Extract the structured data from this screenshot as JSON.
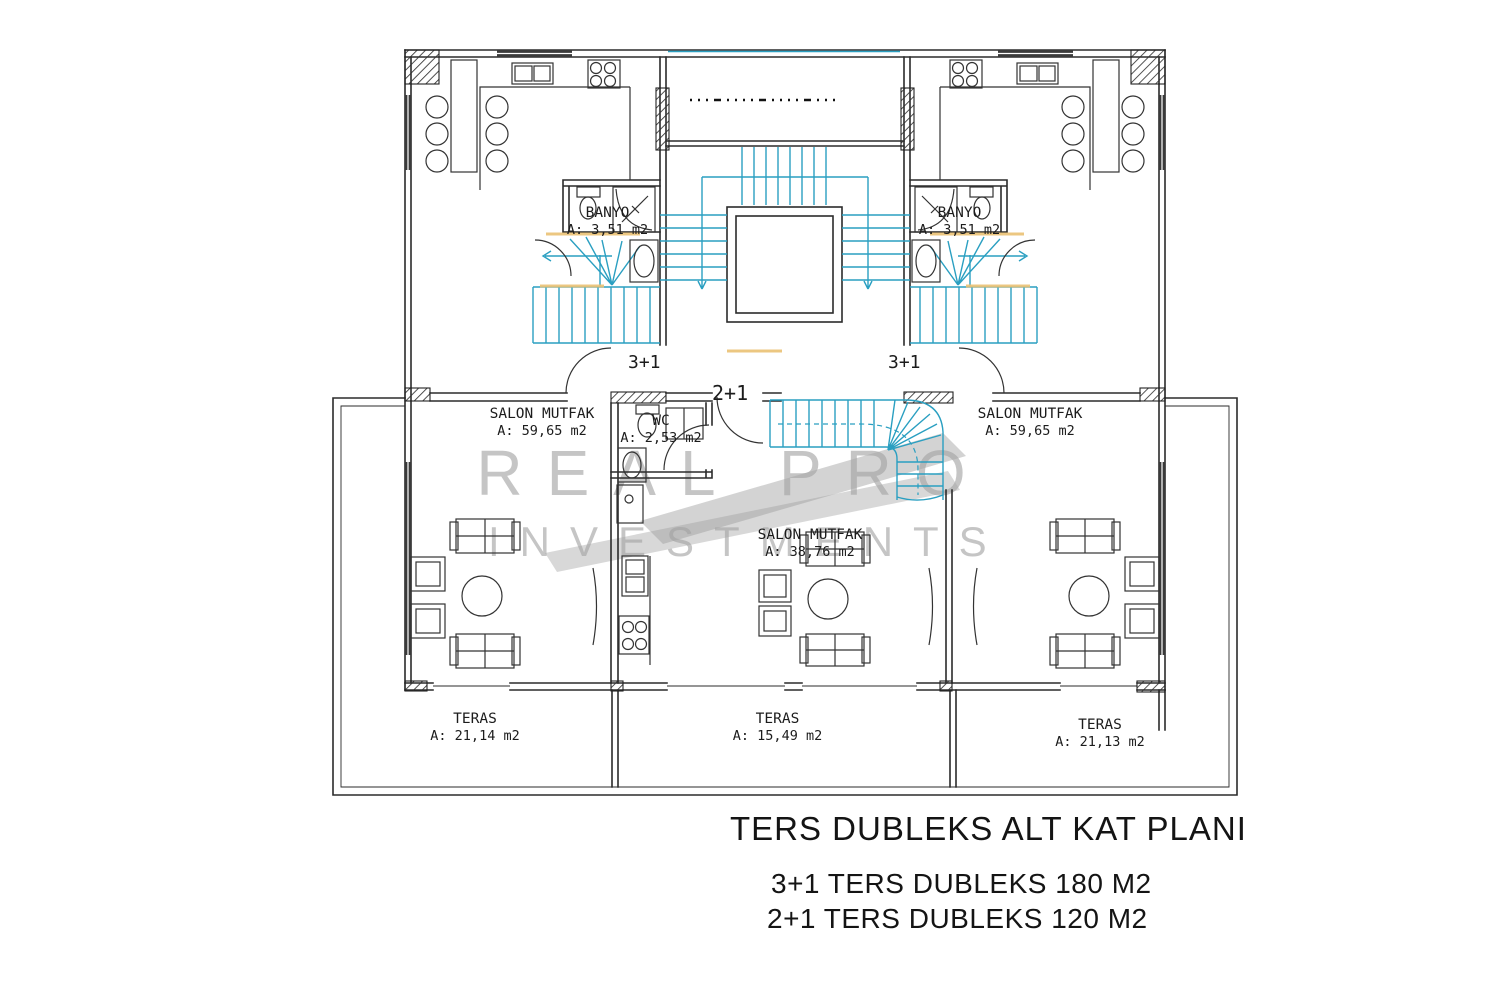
{
  "title_block": {
    "title": "TERS DUBLEKS ALT KAT PLANI",
    "line1": "3+1 TERS DUBLEKS 180 M2",
    "line2": "2+1 TERS DUBLEKS 120 M2"
  },
  "watermark": {
    "line1": "REAL PRO",
    "line2": "INVESTMENTS"
  },
  "units": {
    "left": "3+1",
    "right": "3+1",
    "center": "2+1"
  },
  "rooms": {
    "banyo_left": {
      "name": "BANYO",
      "area": "A: 3,51 m2"
    },
    "banyo_right": {
      "name": "BANYO",
      "area": "A: 3,51 m2"
    },
    "salon_left": {
      "name": "SALON MUTFAK",
      "area": "A: 59,65 m2"
    },
    "salon_right": {
      "name": "SALON MUTFAK",
      "area": "A: 59,65 m2"
    },
    "salon_center": {
      "name": "SALON MUTFAK",
      "area": "A: 38,76 m2"
    },
    "wc": {
      "name": "WC",
      "area": "A: 2,53 m2"
    },
    "teras_left": {
      "name": "TERAS",
      "area": "A: 21,14 m2"
    },
    "teras_center": {
      "name": "TERAS",
      "area": "A: 15,49 m2"
    },
    "teras_right": {
      "name": "TERAS",
      "area": "A: 21,13 m2"
    }
  },
  "colors": {
    "line": "#2b2b2b",
    "stair_cyan": "#2a9fc1",
    "accent_tan": "#eac173",
    "watermark_gray": "#a3a3a3",
    "background": "#ffffff"
  }
}
